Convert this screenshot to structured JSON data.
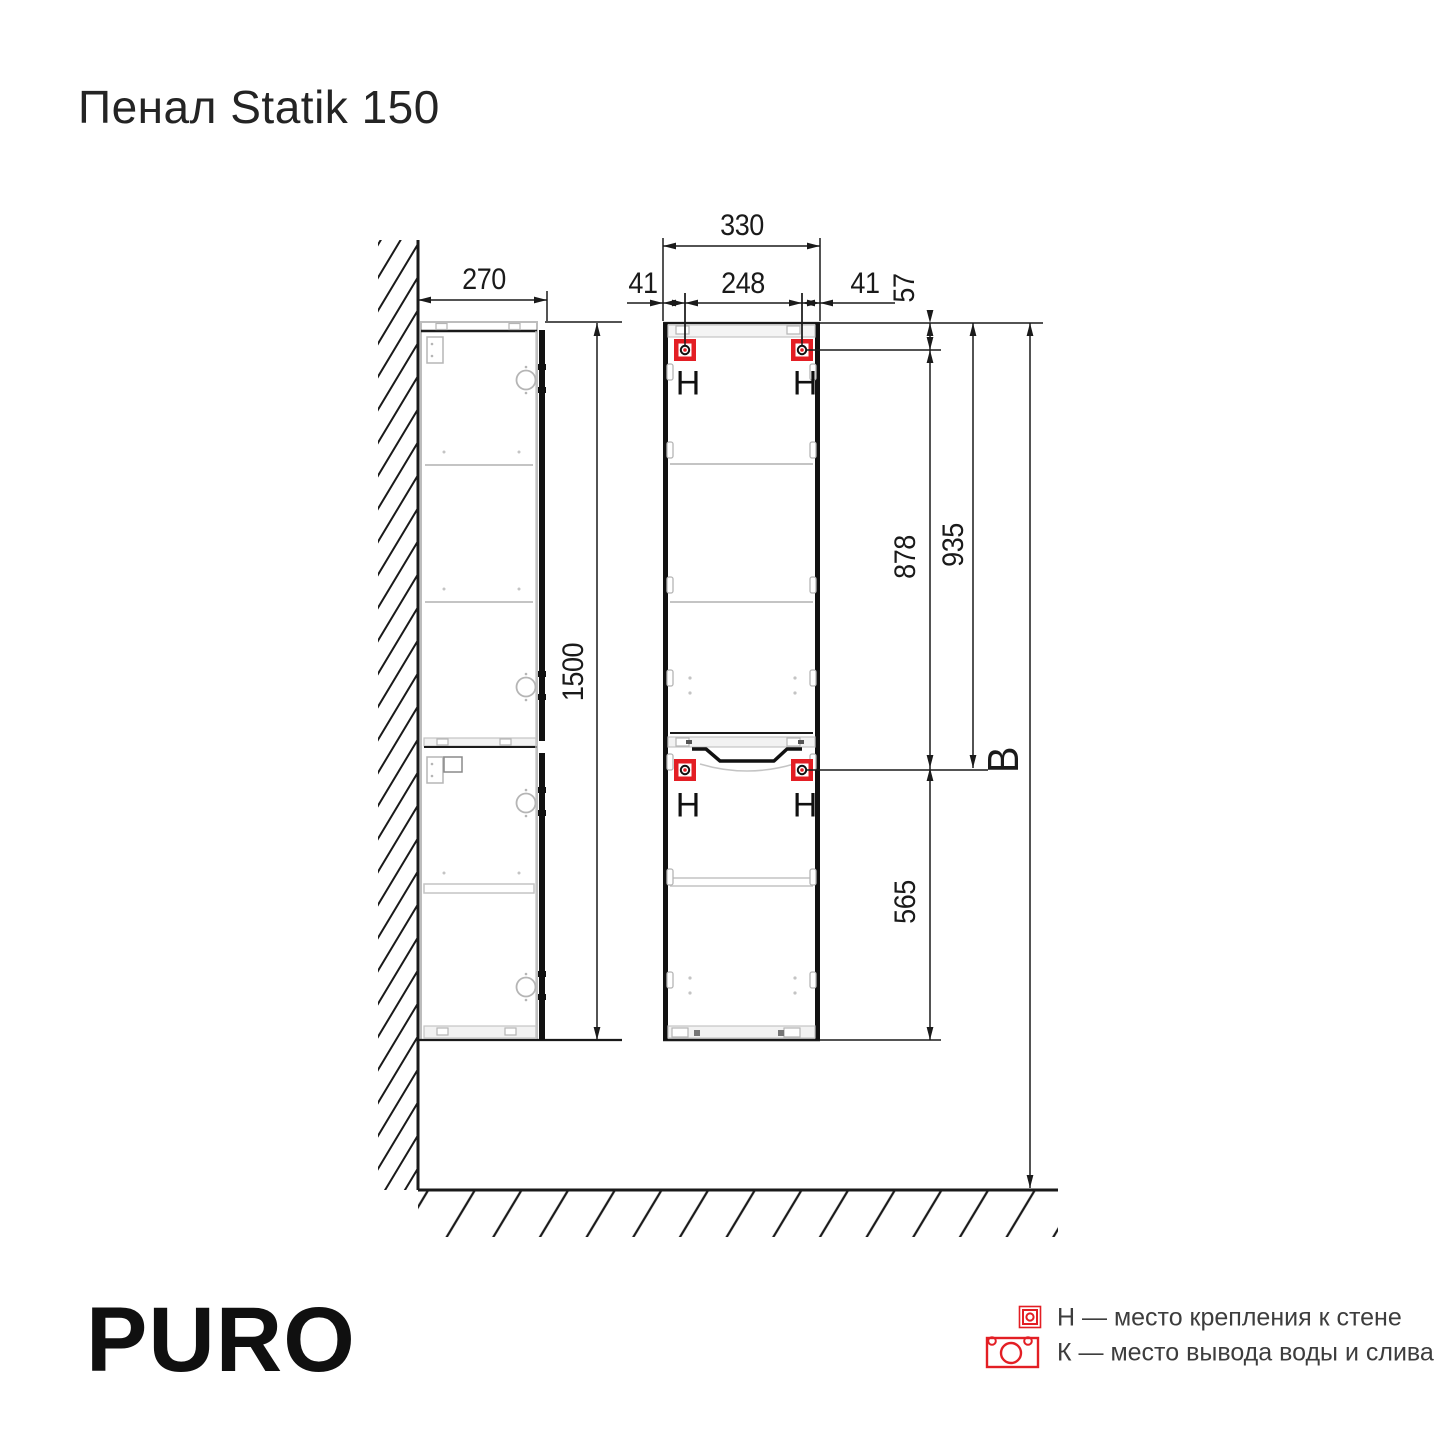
{
  "title": "Пенал Statik 150",
  "brand": "PURO",
  "dimensions": {
    "side_width": "270",
    "side_height": "1500",
    "front_width": "330",
    "front_inner": "248",
    "front_left": "41",
    "front_right": "41",
    "top_offset": "57",
    "mid_span": "878",
    "top_to_mid": "935",
    "bottom_span": "565",
    "install_height": "B"
  },
  "mount_label": "Н",
  "legend": {
    "items": [
      {
        "key": "Н",
        "text": "Н — место крепления к стене"
      },
      {
        "key": "К",
        "text": "К — место вывода воды и слива"
      }
    ]
  },
  "colors": {
    "accent_red": "#e31e24",
    "line_dark": "#1a1a1a",
    "line_light": "#c4c4c4"
  }
}
